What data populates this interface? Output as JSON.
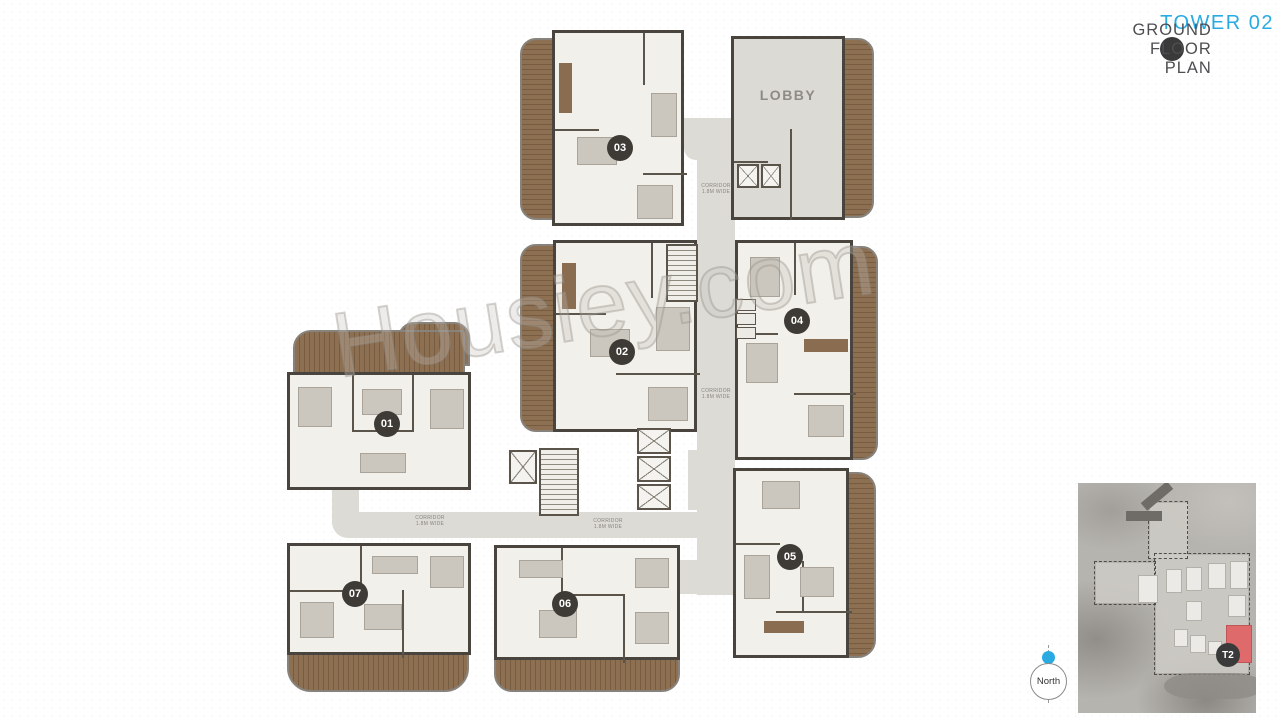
{
  "header": {
    "title": "TOWER 02",
    "subtitle": "GROUND FLOOR PLAN"
  },
  "plan": {
    "lobby_label": "LOBBY",
    "corridor_label": "CORRIDOR",
    "corridor_dim": "1.8M WIDE",
    "units": [
      {
        "label": "01"
      },
      {
        "label": "02"
      },
      {
        "label": "03"
      },
      {
        "label": "04"
      },
      {
        "label": "05"
      },
      {
        "label": "06"
      },
      {
        "label": "07"
      }
    ]
  },
  "watermark": {
    "text": "Housiey.com"
  },
  "compass": {
    "label": "North"
  },
  "sitemap": {
    "tower_badge": "T2",
    "highlight_color": "#df6a6c"
  },
  "colors": {
    "accent": "#29abe2",
    "wall": "#49453e",
    "deck": "#8a6c4f",
    "corridor": "#dcdbd6",
    "floor": "#f2f0ea"
  }
}
